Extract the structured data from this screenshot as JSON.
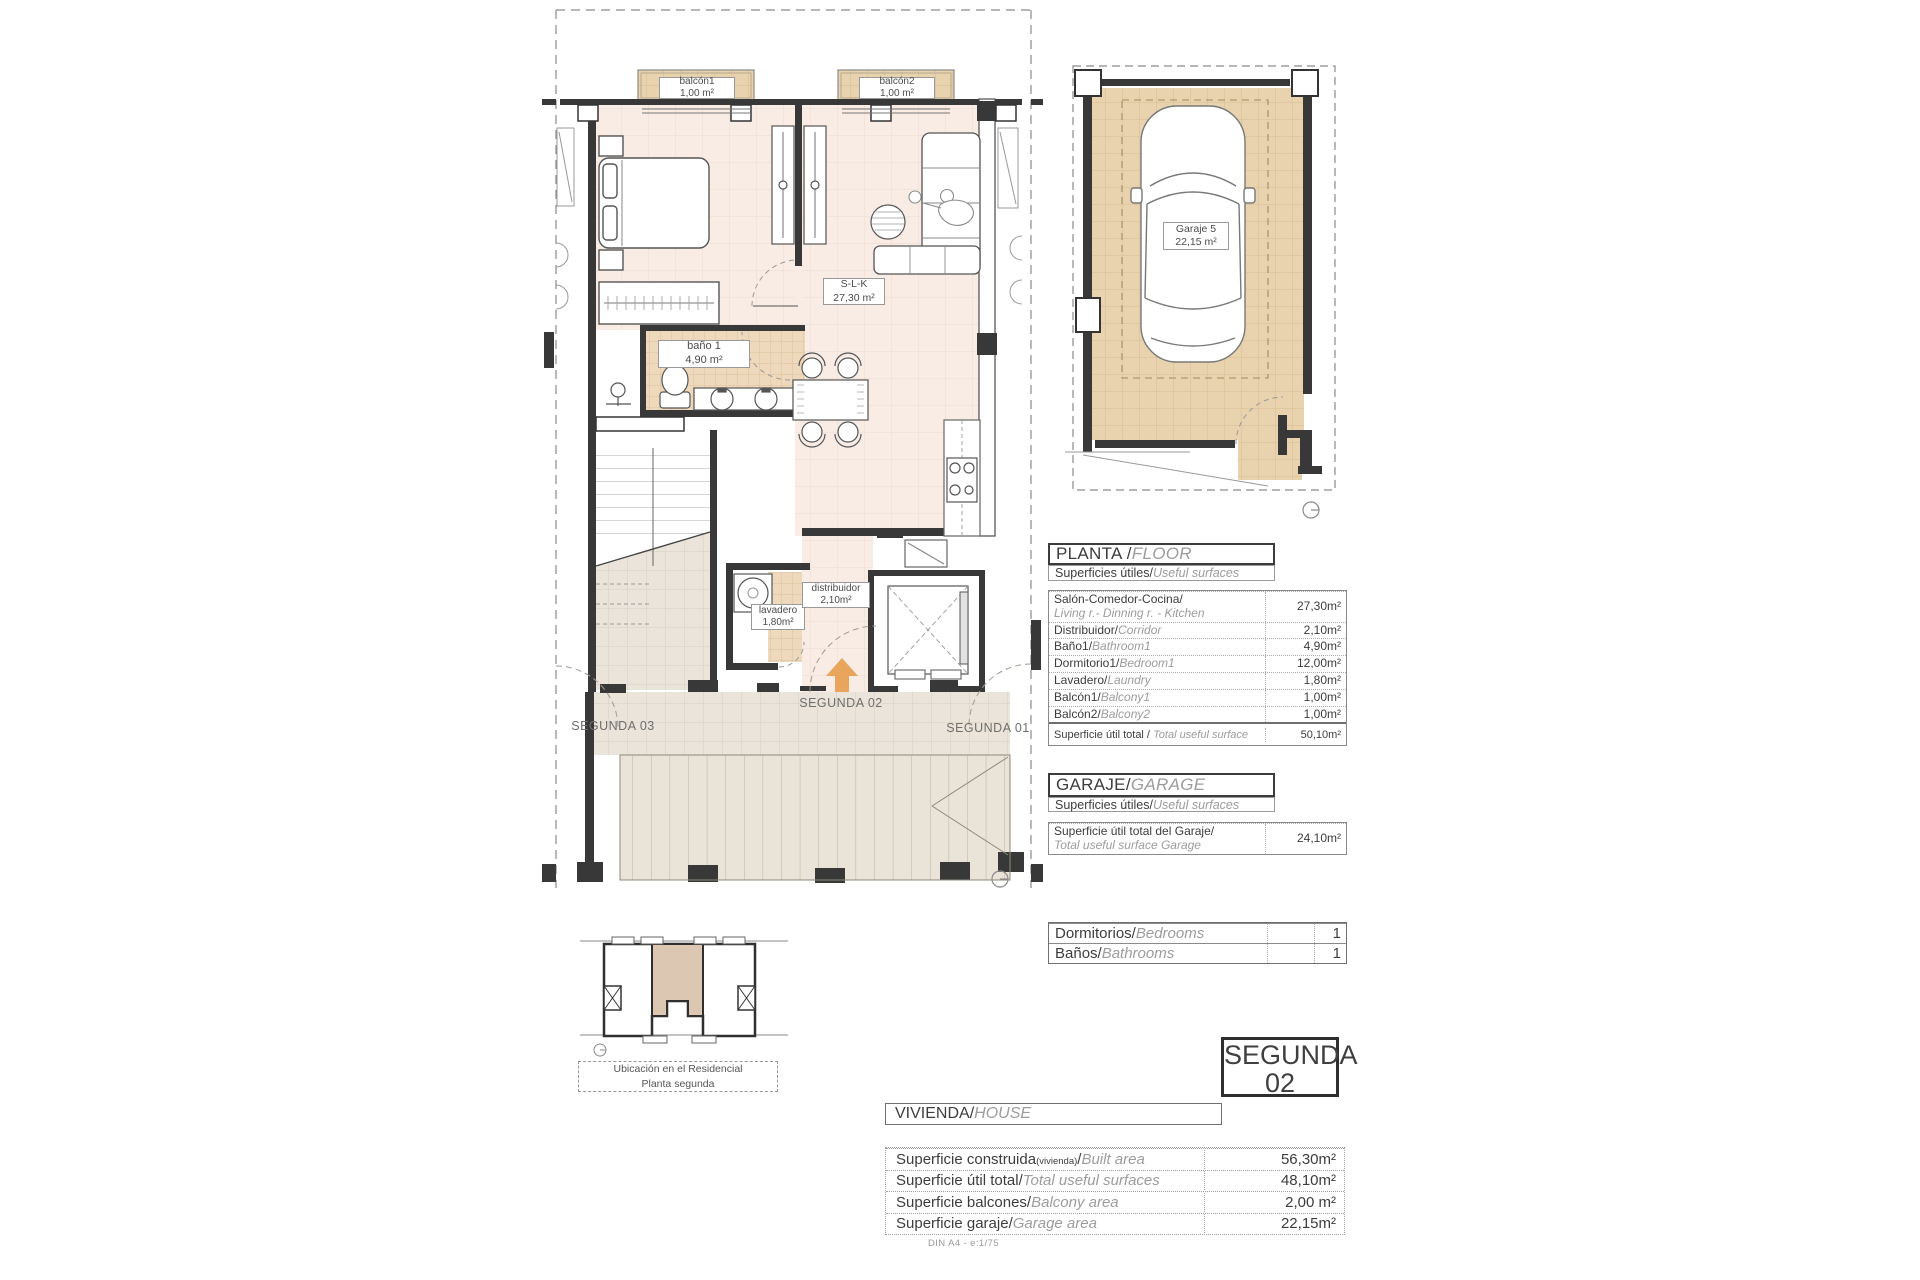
{
  "colors": {
    "floor_pink": "#f8ece5",
    "tile_tan": "#e9d2ae",
    "bath_tan": "#eed9bc",
    "terrace_gray": "#eae4da",
    "wall_dark": "#383838",
    "accent_arrow": "#e9a55b",
    "text_dark": "#3d3d3d",
    "text_italic_gray": "#9c9c9c"
  },
  "plan_labels": {
    "balcony1_name": "balcón1",
    "balcony1_area": "1,00 m²",
    "balcony2_name": "balcón2",
    "balcony2_area": "1,00 m²",
    "slk_name": "S-L-K",
    "slk_area": "27,30 m²",
    "bath_name": "baño 1",
    "bath_area": "4,90 m²",
    "laundry_name": "lavadero",
    "laundry_area": "1,80m²",
    "hall_name": "distribuidor",
    "hall_area": "2,10m²",
    "unit_here": "SEGUNDA 02",
    "unit_left": "SEGUNDA 03",
    "unit_right": "SEGUNDA 01",
    "garage_name": "Garaje 5",
    "garage_area": "22,15 m²"
  },
  "floor_table": {
    "title_es": "PLANTA / ",
    "title_en": "FLOOR",
    "subtitle_es": "Superficies útiles/",
    "subtitle_en": "Useful surfaces",
    "rows": [
      {
        "es": "Salón-Comedor-Cocina/",
        "en": "Living r.- Dinning r. - Kitchen",
        "value": "27,30m²",
        "cls": "block"
      },
      {
        "es": "Distribuidor/",
        "en": "Corridor",
        "value": "2,10m²"
      },
      {
        "es": "Baño1/",
        "en": "Bathroom1",
        "value": "4,90m²"
      },
      {
        "es": "Dormitorio1/",
        "en": "Bedroom1",
        "value": "12,00m²"
      },
      {
        "es": "Lavadero/",
        "en": "Laundry",
        "value": "1,80m²"
      },
      {
        "es": "Balcón1/",
        "en": "Balcony1",
        "value": "1,00m²"
      },
      {
        "es": "Balcón2/",
        "en": "Balcony2",
        "value": "1,00m²"
      },
      {
        "es": "Superficie útil total / ",
        "en": "Total useful surface",
        "value": "50,10m²",
        "cls": "total"
      }
    ]
  },
  "garage_table": {
    "title_es": "GARAJE/",
    "title_en": "GARAGE",
    "subtitle_es": "Superficies útiles/",
    "subtitle_en": "Useful surfaces",
    "rows": [
      {
        "es": "Superficie útil total del Garaje/",
        "en": "Total useful surface Garage",
        "value": "24,10m²",
        "cls": "block"
      }
    ]
  },
  "counts_table": {
    "rows": [
      {
        "es": "Dormitorios/",
        "en": "Bedrooms",
        "value": "1"
      },
      {
        "es": "Baños/",
        "en": "Bathrooms",
        "value": "1"
      }
    ]
  },
  "unit_badge": {
    "line1": "SEGUNDA",
    "line2": "02"
  },
  "house_table": {
    "title_es": "VIVIENDA/",
    "title_en": "HOUSE",
    "rows": [
      {
        "es": "Superficie construida",
        "sub": "(vivienda)",
        "es2": "/",
        "en": "Built area",
        "value": "56,30m²"
      },
      {
        "es": "Superficie útil total/",
        "en": "Total useful surfaces",
        "value": "48,10m²"
      },
      {
        "es": "Superficie balcones/",
        "en": "Balcony area",
        "value": "2,00 m²"
      },
      {
        "es": "Superficie garaje/",
        "en": "Garage area",
        "value": "22,15m²"
      }
    ]
  },
  "location_caption": {
    "line1": "Ubicación en el Residencial",
    "line2": "Planta segunda"
  },
  "footer_note": "DIN A4 - e:1/75"
}
